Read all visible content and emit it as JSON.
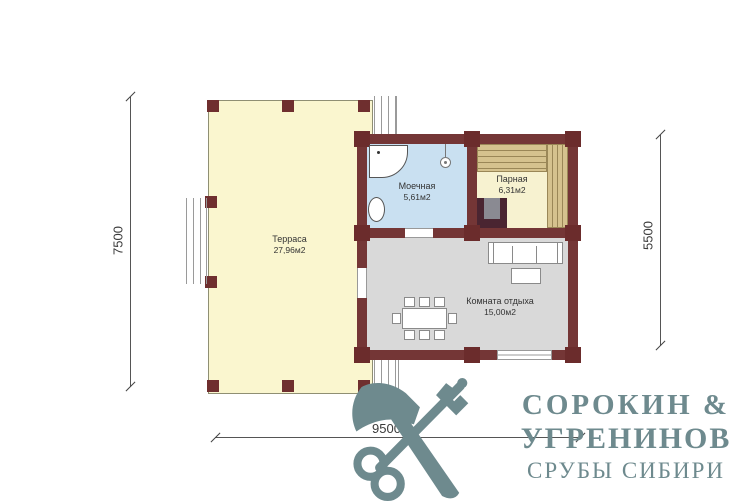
{
  "plan": {
    "rooms": {
      "terrace": {
        "label": "Терраса",
        "area": "27,96м2",
        "fill": "#FAF6CF"
      },
      "washroom": {
        "label": "Моечная",
        "area": "5,61м2",
        "fill": "#C9E0F1"
      },
      "steam": {
        "label": "Парная",
        "area": "6,31м2",
        "fill": "#F7F2D0"
      },
      "lounge": {
        "label": "Комната отдыха",
        "area": "15,00м2",
        "fill": "#D9D9D9"
      }
    },
    "wall_color": "#743636",
    "bench_color": "#D5C28E",
    "dimensions": {
      "left": "7500",
      "right": "5500",
      "bottom": "9500"
    }
  },
  "logo": {
    "icon": "axe-and-key-icon",
    "color": "#6E8A8E",
    "line1": "СОРОКИН &",
    "line2": "УГРЕНИНОВ",
    "line3": "СРУБЫ СИБИРИ"
  }
}
